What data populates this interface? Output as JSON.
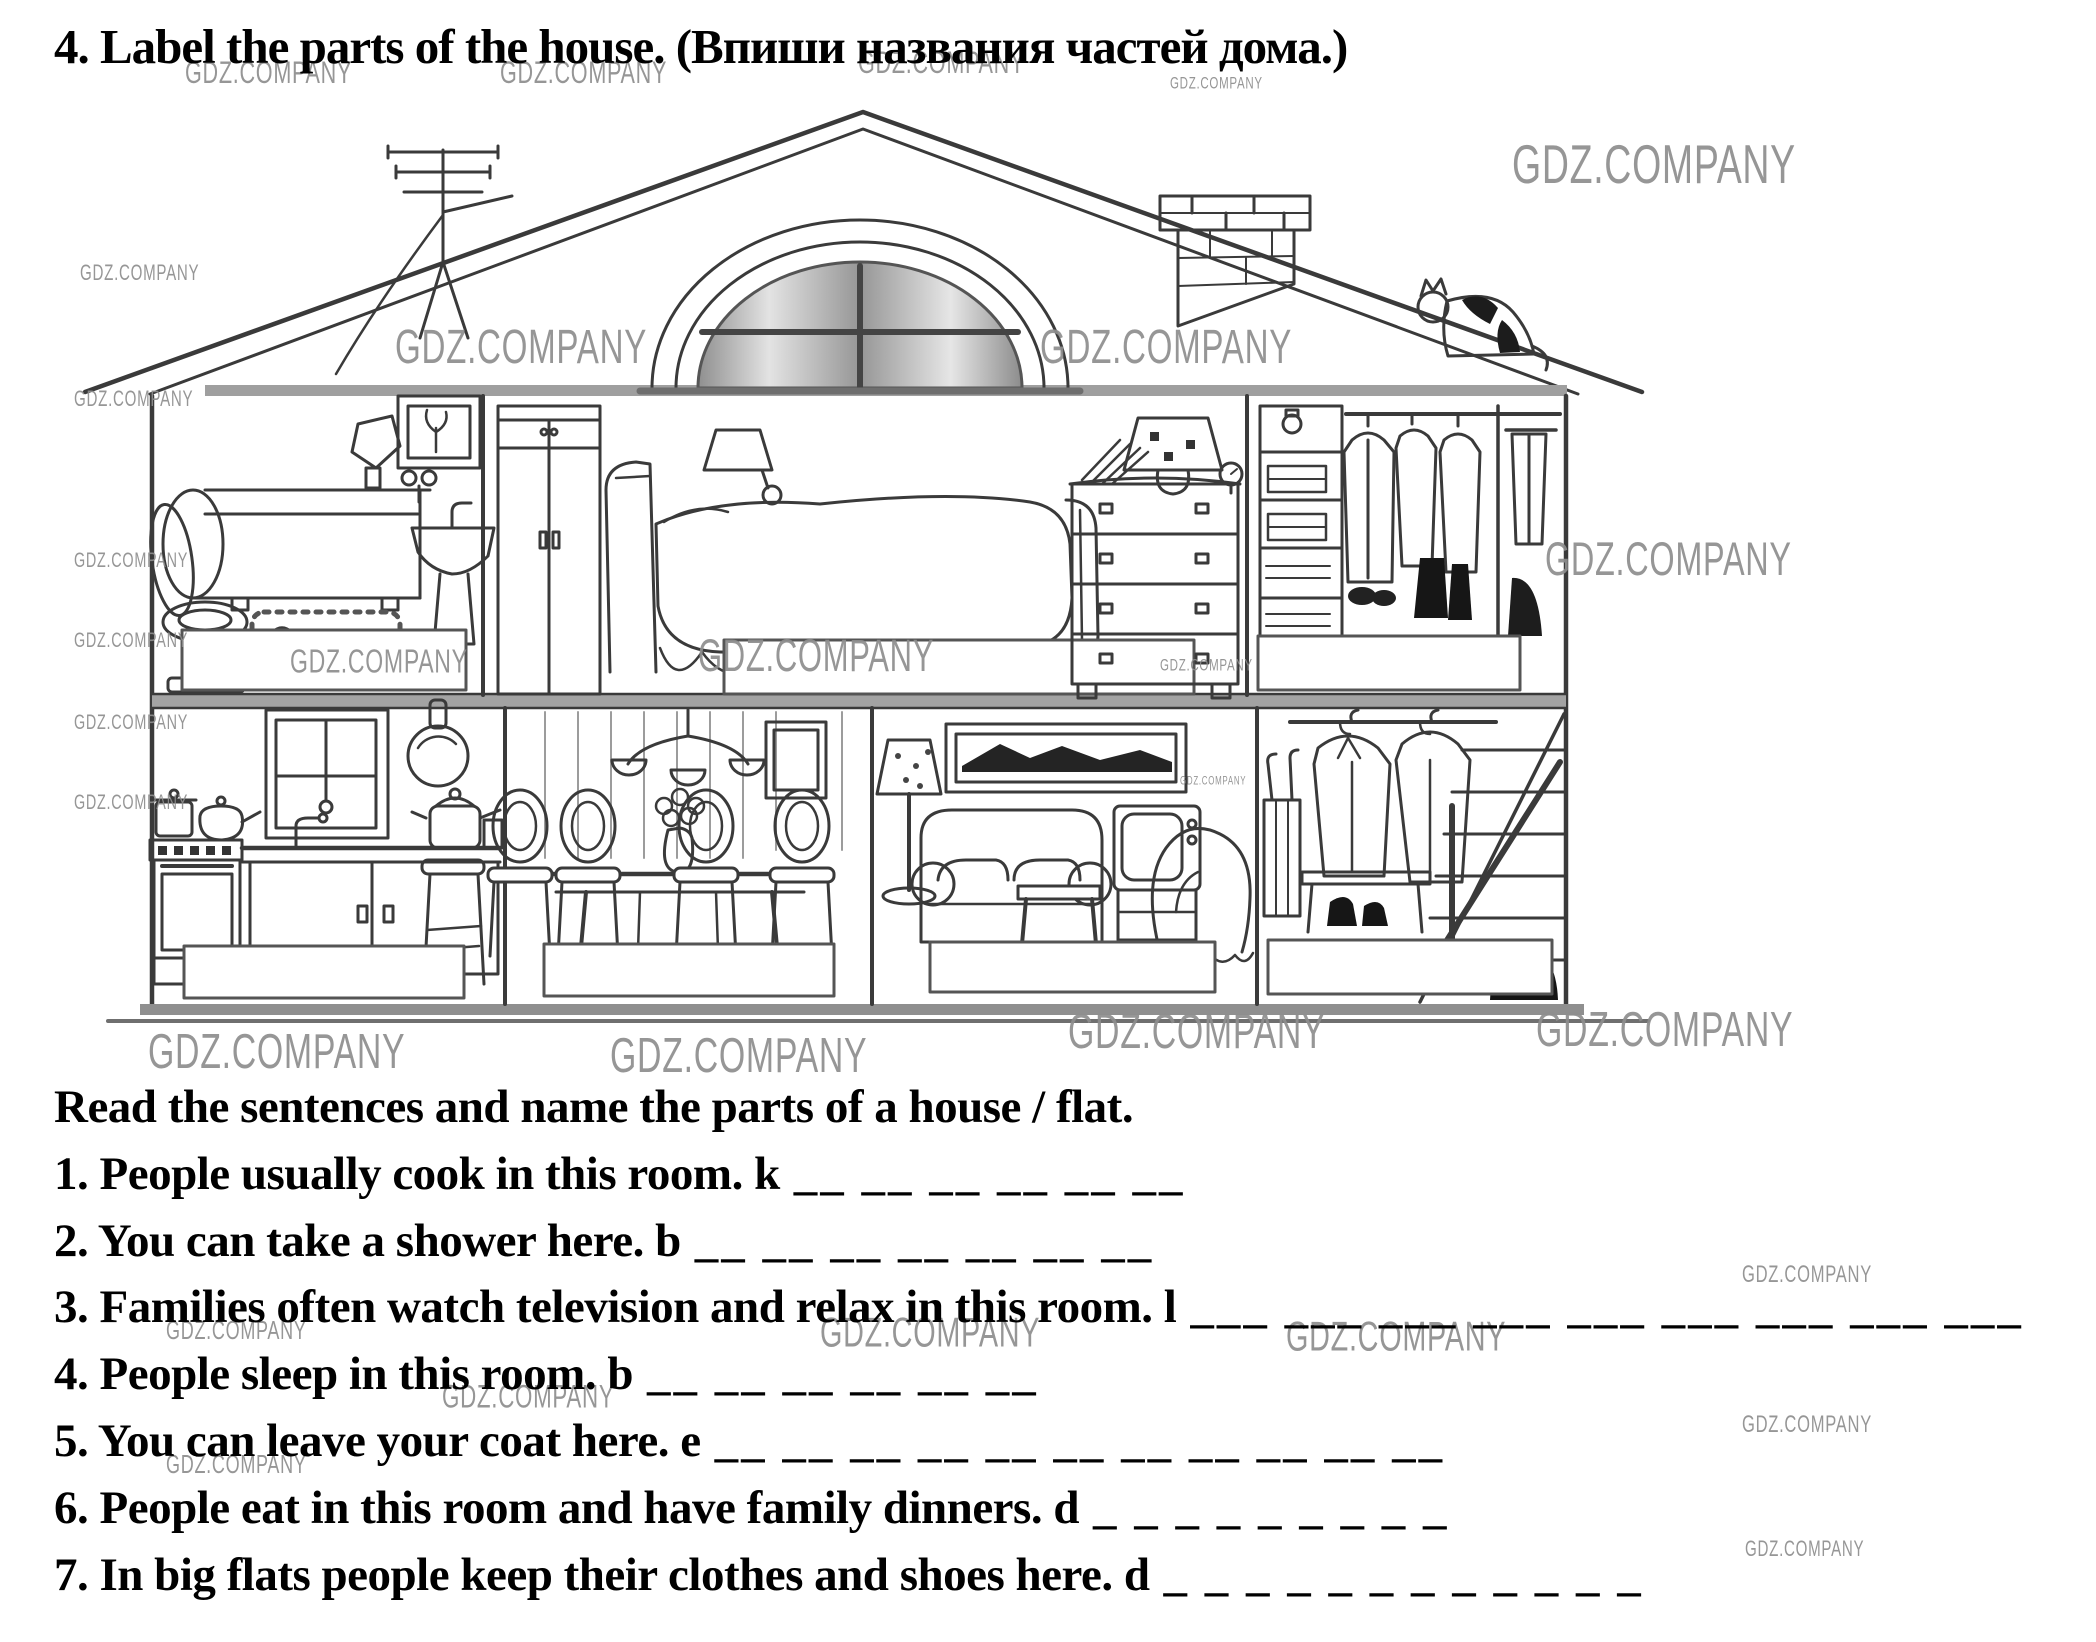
{
  "page": {
    "title": "4. Label the parts of the house. (Впиши названия частей дома.)",
    "instruction": "Read the sentences and name the parts of a house / flat."
  },
  "watermark": {
    "text": "GDZ.COMPANY",
    "color": "#8e8e8e"
  },
  "watermark_instances": [
    {
      "x": 185,
      "y": 58,
      "size": 30
    },
    {
      "x": 500,
      "y": 58,
      "size": 30
    },
    {
      "x": 858,
      "y": 48,
      "size": 30
    },
    {
      "x": 1170,
      "y": 76,
      "size": 16
    },
    {
      "x": 1512,
      "y": 138,
      "size": 52
    },
    {
      "x": 80,
      "y": 262,
      "size": 21
    },
    {
      "x": 395,
      "y": 322,
      "size": 46
    },
    {
      "x": 1040,
      "y": 322,
      "size": 46
    },
    {
      "x": 74,
      "y": 388,
      "size": 21
    },
    {
      "x": 74,
      "y": 550,
      "size": 20
    },
    {
      "x": 74,
      "y": 630,
      "size": 20
    },
    {
      "x": 74,
      "y": 712,
      "size": 20
    },
    {
      "x": 74,
      "y": 792,
      "size": 20
    },
    {
      "x": 290,
      "y": 644,
      "size": 32
    },
    {
      "x": 698,
      "y": 634,
      "size": 43
    },
    {
      "x": 1160,
      "y": 658,
      "size": 16
    },
    {
      "x": 1545,
      "y": 535,
      "size": 45
    },
    {
      "x": 1180,
      "y": 776,
      "size": 11
    },
    {
      "x": 148,
      "y": 1026,
      "size": 47
    },
    {
      "x": 610,
      "y": 1030,
      "size": 47
    },
    {
      "x": 1068,
      "y": 1006,
      "size": 47
    },
    {
      "x": 1536,
      "y": 1004,
      "size": 47
    },
    {
      "x": 820,
      "y": 1312,
      "size": 40
    },
    {
      "x": 1286,
      "y": 1316,
      "size": 40
    },
    {
      "x": 166,
      "y": 1318,
      "size": 25
    },
    {
      "x": 442,
      "y": 1380,
      "size": 31
    },
    {
      "x": 166,
      "y": 1452,
      "size": 25
    },
    {
      "x": 1742,
      "y": 1262,
      "size": 23
    },
    {
      "x": 1742,
      "y": 1412,
      "size": 23
    },
    {
      "x": 1745,
      "y": 1538,
      "size": 21
    }
  ],
  "exercise": {
    "sentences": [
      {
        "text": "1. People usually cook in this room. k",
        "blank": "__ __ __ __ __ __"
      },
      {
        "text": "2. You can take a shower here. b",
        "blank": "__ __ __ __ __ __ __"
      },
      {
        "text": "3. Families often watch television and relax in this room. l",
        "blank": "___ ___ ___ ___ ___ ___ ___ ___ ___"
      },
      {
        "text": "4. People sleep in this room. b",
        "blank": "__ __ __ __ __ __"
      },
      {
        "text": "5. You can leave your coat here. e",
        "blank": "__ __ __ __ __ __ __ __ __ __ __"
      },
      {
        "text": "6. People eat in this room and have family dinners. d",
        "blank": "_ _ _ _ _ _ _ _ _"
      },
      {
        "text": "7. In big flats people keep their clothes and shoes here. d",
        "blank": "_ _ _ _ _ _ _ _ _ _ _ _"
      }
    ]
  },
  "house": {
    "ink": "#3a3a3a",
    "shade": "#a0a0a0",
    "label_box_count": 7
  }
}
